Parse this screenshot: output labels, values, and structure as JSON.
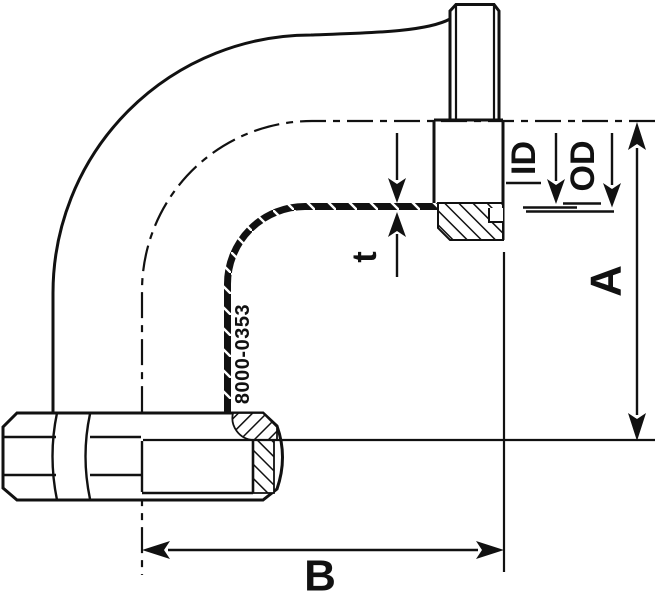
{
  "drawing": {
    "part_number": "8000-0353",
    "dimensions": {
      "a_label": "A",
      "b_label": "B",
      "thickness_label": "t",
      "inner_diameter_label": "ID",
      "outer_diameter_label": "OD"
    },
    "colors": {
      "line": "#111111",
      "background": "#ffffff"
    }
  }
}
